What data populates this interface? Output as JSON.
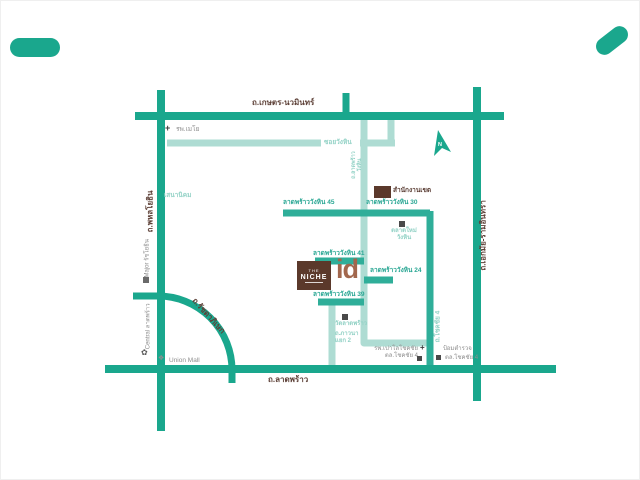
{
  "roads": {
    "kaset": "ถ.เกษตร-นวมินทร์",
    "phahonyothin": "ถ.พหลโยธิน",
    "ekamai": "ถ.เอกมัย-รามอินทรา",
    "ladprao": "ถ.ลาดพร้าว",
    "ratchada": "ถ.รัชดาภิเษก",
    "wanghin_soi": "ซอยวังหิน",
    "ladprao_wanghin_1": "ถ.ลาดพร้าว",
    "ladprao_wanghin_2": "วังหิน",
    "chokchai4": "ถ.โชคชัย 4",
    "sena_nikhom": "เสนานิคม",
    "phawana_1": "ถ.ภาวนา",
    "phawana_2": "แยก 2"
  },
  "sois": {
    "s45": "ลาดพร้าววังหิน 45",
    "s30": "ลาดพร้าววังหิน 30",
    "s41": "ลาดพร้าววังหิน 41",
    "s24": "ลาดพร้าววังหิน 24",
    "s39": "ลาดพร้าววังหิน 39"
  },
  "places": {
    "mayo_hospital": "รพ.เมโย",
    "district_office": "สำนักงานเขต",
    "market_1": "ตลาดใหม่",
    "market_2": "วังหิน",
    "wat_ladprao": "วัดลาดพร้าว",
    "major": "Major รัชโยธิน",
    "central": "Central ลาดพร้าว",
    "union_mall": "Union Mall",
    "paolo_1": "รพ.เปาโลโชคชัย",
    "paolo_2": "ตล.โชคชัย 4",
    "police_1": "ป้อมตำรวจ",
    "police_2": "ตล.โชคชัย 4"
  },
  "logo": {
    "the": "THE",
    "niche": "NICHE",
    "id": "id"
  },
  "compass": {
    "n": "N"
  },
  "colors": {
    "road_dark": "#1aa78d",
    "road_light": "#aedcd3",
    "road_mid": "#2fae99",
    "text_brown": "#5d4037",
    "text_teal": "#2aa794",
    "text_light": "#93d2c6",
    "text_grey": "#8e8e8e",
    "logo_brown": "#5b392b",
    "id_brown": "#a2674d"
  }
}
